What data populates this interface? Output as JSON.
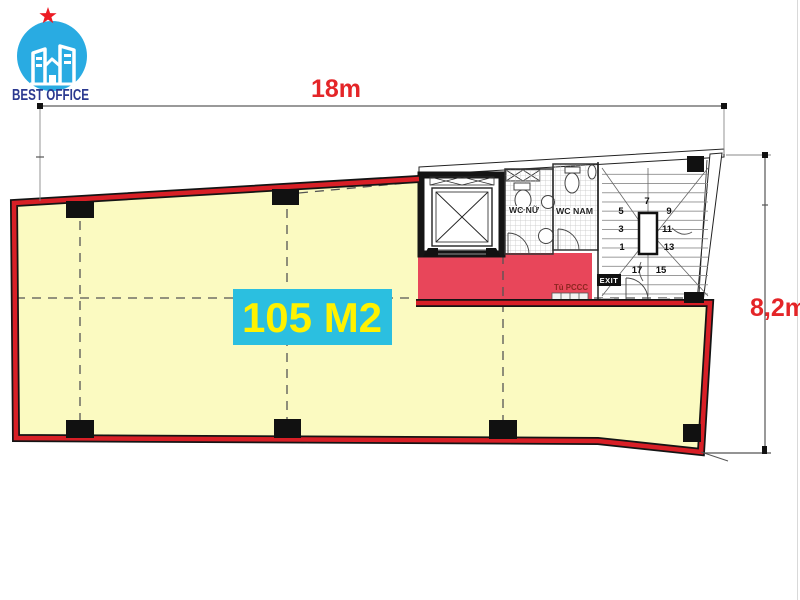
{
  "brand": {
    "name": "BEST OFFICE"
  },
  "dimensions": {
    "width": "18m",
    "height": "8,2m"
  },
  "area": {
    "label": "105 M2"
  },
  "rooms": {
    "wc_female": "WC NỮ",
    "wc_male": "WC NAM",
    "fire_cabinet": "Tủ PCCC",
    "exit": "EXIT"
  },
  "stairs": {
    "steps": [
      "1",
      "3",
      "5",
      "7",
      "9",
      "11",
      "13",
      "15",
      "17"
    ]
  },
  "colors": {
    "floor_fill": "#FBFAC1",
    "corridor_fill": "#E8465A",
    "boundary_red": "#D81F26",
    "area_bg": "#2BBFE0",
    "area_fg": "#FFF200",
    "dim_red": "#E42528",
    "logo_blue": "#29ABE2",
    "logo_navy": "#2B3990",
    "star_red": "#EC1C24"
  }
}
